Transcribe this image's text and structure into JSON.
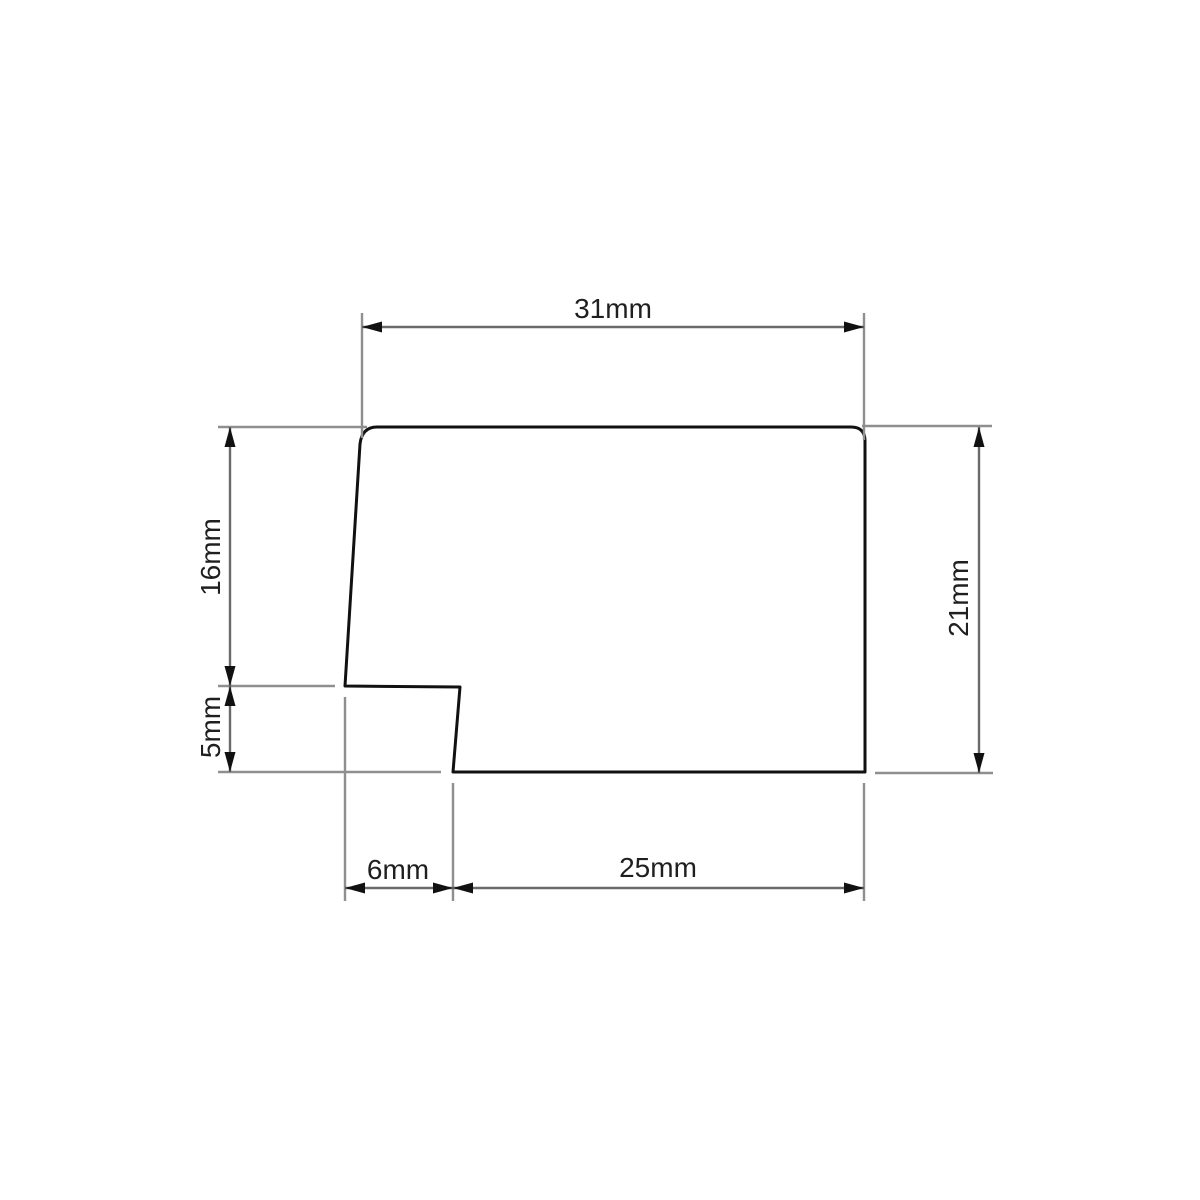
{
  "drawing": {
    "type": "technical-dimension-drawing",
    "subject": "profile cross-section with notched bottom-left corner",
    "unit": "mm",
    "dimensions": {
      "top_width": {
        "value": 31,
        "label": "31mm"
      },
      "upper_left_height": {
        "value": 16,
        "label": "16mm"
      },
      "lower_left_height": {
        "value": 5,
        "label": "5mm"
      },
      "right_height": {
        "value": 21,
        "label": "21mm"
      },
      "bottom_left_width": {
        "value": 6,
        "label": "6mm"
      },
      "bottom_right_width": {
        "value": 25,
        "label": "25mm"
      }
    },
    "colors": {
      "background": "#ffffff",
      "outline": "#111111",
      "dimension_line": "#6a6a6a",
      "extension_line": "#8f8f8f",
      "arrow": "#111111",
      "text": "#1f1f1f"
    }
  }
}
